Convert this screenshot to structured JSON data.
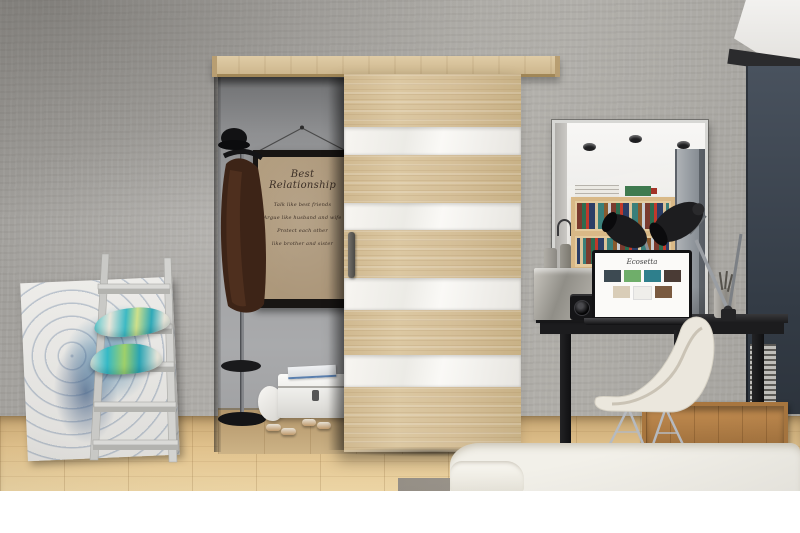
{
  "image": {
    "type": "interior product photograph",
    "alt": "Modern interior with a sliding sonoma-oak door striped with white gloss panels, concrete walls, a closet alcove with a framed quote poster and coat stand, a ladder shelf with teal pillows and abstract painting, and a black home-office desk with mirror, laptop, lamp and white shell chair"
  },
  "poster": {
    "title": "Best Relationship",
    "lines": [
      "Talk like best friends",
      "Argue like husband and wife",
      "Protect each other",
      "like brother and sister"
    ]
  },
  "laptop": {
    "screen_logo": "Ecosetta"
  },
  "colors": {
    "wall_concrete": "#aca9a5",
    "door_oak": "#d5bf98",
    "door_white_gloss": "#f4f2ee",
    "desk_black": "#1b1b1d",
    "floor_wood": "#ddbd8a",
    "pillow_teal": "#3fc8d1",
    "passage_navy": "#3a434e",
    "bed_white": "#f2f0e9",
    "crate_wood": "#b07c44",
    "poster_canvas": "#ac977a"
  }
}
